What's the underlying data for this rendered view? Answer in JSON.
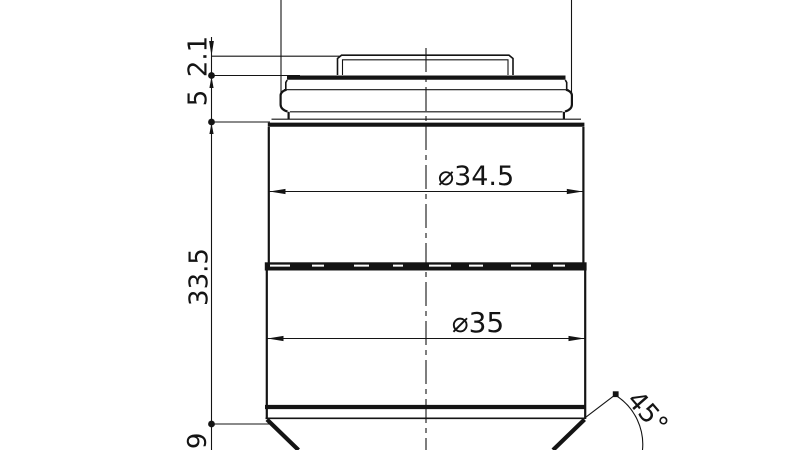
{
  "drawing": {
    "colors": {
      "line": "#141414",
      "background": "#ffffff"
    },
    "dimensions": {
      "cap_offset": "2.1",
      "flange_height": "5",
      "body_length": "33.5",
      "bottom_partial": ".9",
      "upper_body_diameter": "⌀34.5",
      "lower_body_diameter": "⌀35",
      "tip_chamfer_angle": "45°"
    }
  }
}
